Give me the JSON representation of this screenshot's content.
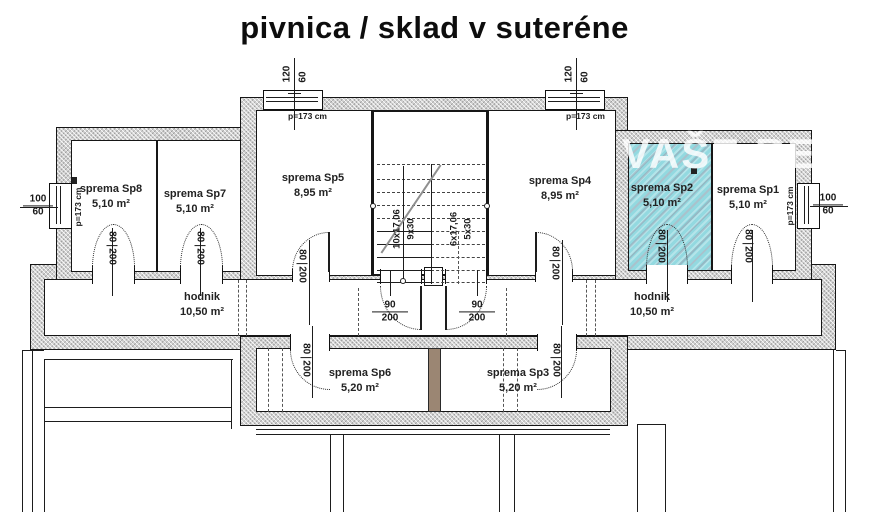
{
  "title": "pivnica / sklad v suteréne",
  "watermark": "VAŠE REALIT",
  "rooms": {
    "sp8": {
      "name": "sprema Sp8",
      "area": "5,10 m²"
    },
    "sp7": {
      "name": "sprema Sp7",
      "area": "5,10 m²"
    },
    "sp5": {
      "name": "sprema Sp5",
      "area": "8,95 m²"
    },
    "sp4": {
      "name": "sprema Sp4",
      "area": "8,95 m²"
    },
    "sp2": {
      "name": "sprema Sp2",
      "area": "5,10 m²"
    },
    "sp1": {
      "name": "sprema Sp1",
      "area": "5,10 m²"
    },
    "sp6": {
      "name": "sprema Sp6",
      "area": "5,20 m²"
    },
    "sp3": {
      "name": "sprema Sp3",
      "area": "5,20 m²"
    },
    "hodnik_left": {
      "name": "hodnik",
      "area": "10,50 m²"
    },
    "hodnik_right": {
      "name": "hodnik",
      "area": "10,50 m²"
    }
  },
  "dims": {
    "door_w": "80",
    "door_h": "200",
    "stair_door_w": "90",
    "stair_door_h": "200",
    "top_window_w": "120",
    "top_window_h": "60",
    "side_window_w": "100",
    "side_window_h": "60",
    "parapet": "p=173 cm"
  },
  "stairs": {
    "flight_main_risers": "10x17,06",
    "flight_main_treads": "9x30",
    "flight_sec_risers": "6x17,06",
    "flight_sec_treads": "5x30"
  },
  "colors": {
    "highlight": "#93d9e0",
    "wall": "#d0d0d0",
    "divider": "#9b8673"
  }
}
